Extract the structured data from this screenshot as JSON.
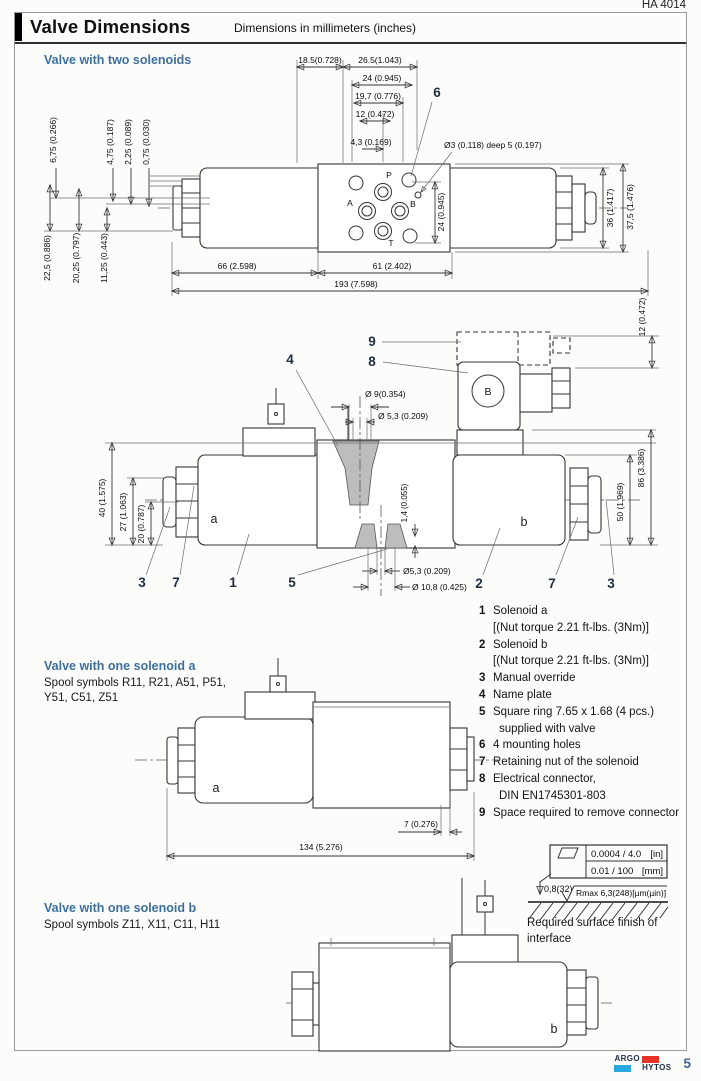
{
  "page": {
    "doc_number": "HA 4014",
    "page_number": "5",
    "title": "Valve Dimensions",
    "subtitle": "Dimensions in millimeters (inches)"
  },
  "logo": {
    "argo": "ARGO",
    "hytos": "HYTOS",
    "red": "#e63329",
    "blue": "#29a8df"
  },
  "d1": {
    "heading": "Valve with two solenoids",
    "dims_top": {
      "w1": "18.5(0.728)",
      "w2": "26.5(1.043)",
      "w3": "24 (0.945)",
      "w4": "19,7 (0.776)",
      "w5": "12 (0.472)",
      "w6": "4,3 (0.169)"
    },
    "callout_6": "6",
    "hole_note": "Ø3 (0.118) deep 5 (0.197)",
    "dims_left_top": {
      "v1": "6,75 (0.266)",
      "v2": "4,75 (0.187)",
      "v3": "2,25 (0.089)",
      "v4": "0,75 (0.030)"
    },
    "dims_left_bottom": {
      "v1": "22,5 (0.886)",
      "v2": "20,25 (0.797)",
      "v3": "11,25 (0.443)"
    },
    "dims_right": {
      "v1": "24 (0.945)",
      "v2": "36 (1.417)",
      "v3": "37,5 (1.476)"
    },
    "dims_bottom": {
      "b1": "66 (2.598)",
      "b2": "61 (2.402)",
      "b3": "193 (7.598)"
    },
    "ports": {
      "p": "P",
      "a": "A",
      "b": "B",
      "t": "T"
    }
  },
  "d2": {
    "callout_9": "9",
    "callout_8": "8",
    "callout_4": "4",
    "connector_label": "B",
    "dim_space": "12 (0.472)",
    "dia_9": "Ø 9(0.354)",
    "dia_53_top": "Ø 5,3 (0.209)",
    "dims_left": {
      "v1": "40 (1.575)",
      "v2": "27 (1.063)",
      "v3": "20 (0.787)"
    },
    "dims_right": {
      "v1": "86 (3.386)",
      "v2": "50 (1.969)"
    },
    "dim_14": "1,4 (0.055)",
    "dia_53_bottom": "Ø5,3 (0.209)",
    "dia_108": "Ø 10,8 (0.425)",
    "label_a": "a",
    "label_b": "b",
    "callouts_bottom": {
      "c1": "3",
      "c2": "7",
      "c3": "1",
      "c4": "5",
      "c5": "2",
      "c6": "7",
      "c7": "3"
    }
  },
  "legend": {
    "rows": [
      {
        "num": "1",
        "text": "Solenoid a"
      },
      {
        "num": "",
        "text": "[(Nut torque 2.21 ft-lbs. (3Nm)]"
      },
      {
        "num": "2",
        "text": "Solenoid b"
      },
      {
        "num": "",
        "text": "[(Nut torque 2.21 ft-lbs. (3Nm)]"
      },
      {
        "num": "3",
        "text": "Manual override"
      },
      {
        "num": "4",
        "text": "Name plate"
      },
      {
        "num": "5",
        "text": "Square ring 7.65 x 1.68 (4 pcs.)"
      },
      {
        "num": "",
        "text": "supplied with valve"
      },
      {
        "num": "6",
        "text": "4 mounting holes"
      },
      {
        "num": "7",
        "text": "Retaining nut of the solenoid"
      },
      {
        "num": "8",
        "text": "Electrical connector,"
      },
      {
        "num": "",
        "text": "DIN EN1745301-803"
      },
      {
        "num": "9",
        "text": "Space required to remove connector"
      }
    ]
  },
  "sol_a": {
    "heading": "Valve with one solenoid a",
    "spool_line1": "Spool symbols R11, R21, A51, P51,",
    "spool_line2": "Y51, C51, Z51",
    "label_a": "a",
    "dim_7": "7 (0.276)",
    "dim_134": "134 (5.276)"
  },
  "surface": {
    "row_in": "0.0004 / 4.0",
    "unit_in": "[in]",
    "row_mm": "0.01 / 100",
    "unit_mm": "[mm]",
    "roughness": "0,8(32)",
    "rmax": "Rmax 6,3(248)[µm(µin)]",
    "caption_line1": "Required surface finish of",
    "caption_line2": "interface"
  },
  "sol_b": {
    "heading": "Valve with one solenoid b",
    "spool_line": "Spool symbols Z11, X11, C11, H11",
    "label_b": "b"
  }
}
